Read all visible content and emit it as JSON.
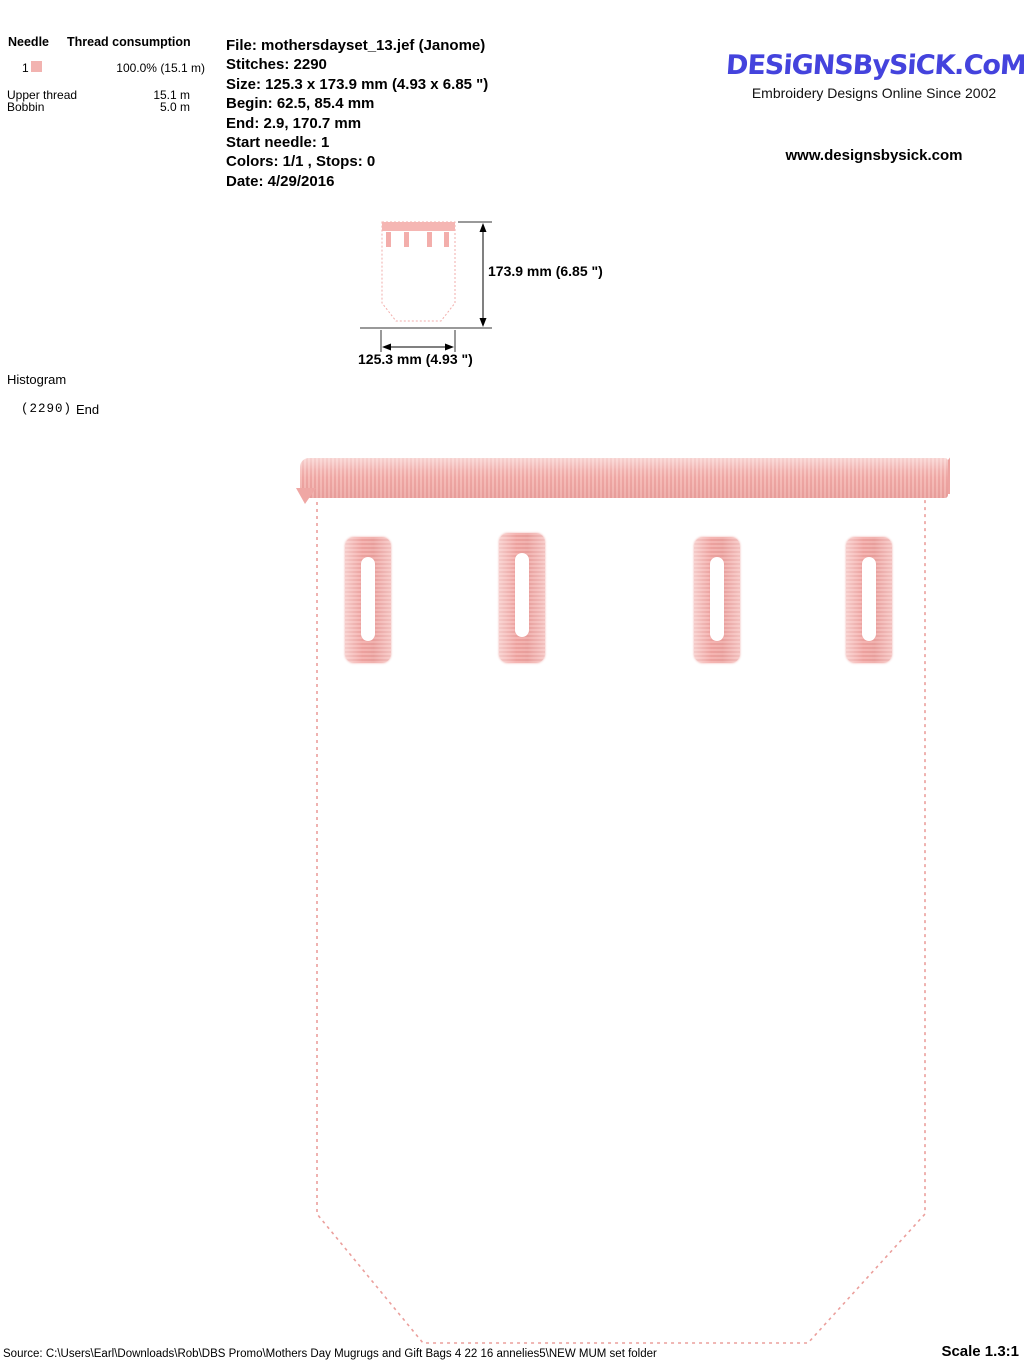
{
  "thread_table": {
    "needle_header": "Needle",
    "consumption_header": "Thread consumption",
    "needle_number": "1",
    "needle_color": "#f2b3b0",
    "needle_consumption": "100.0% (15.1 m)",
    "upper_thread_label": "Upper thread",
    "upper_thread_value": "15.1 m",
    "bobbin_label": "Bobbin",
    "bobbin_value": "5.0 m"
  },
  "file_info": {
    "lines": [
      "File: mothersdayset_13.jef  (Janome)",
      "Stitches: 2290",
      "Size: 125.3 x 173.9 mm (4.93 x 6.85 \")",
      "Begin: 62.5, 85.4 mm",
      "End: 2.9, 170.7 mm",
      "Start needle: 1",
      "Colors: 1/1 , Stops: 0",
      "Date: 4/29/2016"
    ]
  },
  "branding": {
    "logo_text": "DESiGNSBySiCK.CoM",
    "logo_color": "#4443dd",
    "tagline": "Embroidery Designs Online Since 2002",
    "website": "www.designsbysick.com"
  },
  "thumbnail": {
    "height_label": "173.9 mm (6.85 \")",
    "width_label": "125.3 mm (4.93 \")"
  },
  "histogram": {
    "title": "Histogram",
    "stitch_count": "(2290)",
    "end_label": "End"
  },
  "design": {
    "thread_color": "#f2aca9",
    "outline_color": "#eb9f9c",
    "slot_count": 4
  },
  "footer": {
    "source": "Source: C:\\Users\\Earl\\Downloads\\Rob\\DBS Promo\\Mothers Day Mugrugs and Gift Bags 4 22 16 annelies5\\NEW MUM set folder",
    "scale": "Scale 1.3:1"
  }
}
